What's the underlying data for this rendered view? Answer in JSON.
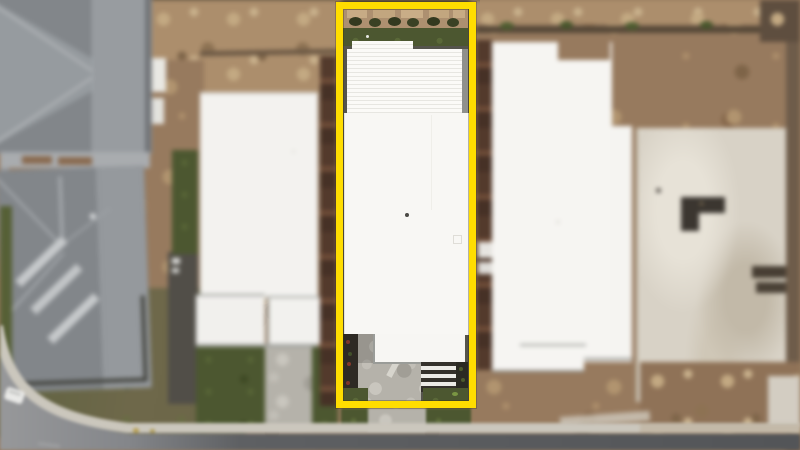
{
  "scene": {
    "kind": "aerial-drone-photo",
    "subject": "residential-lot-highlighted-with-yellow-boundary",
    "highlight": {
      "shape": "rectangle-outline",
      "color_ref": "highlight"
    },
    "regions": [
      "gray-roof-house-top-left",
      "gray-roof-house-left",
      "white-roof-building-left",
      "highlighted-lot-white-roof-house",
      "white-roof-building-right",
      "concrete-slab-construction-site-right",
      "dirt-vacant-ground",
      "front-garden-and-turf",
      "driveway",
      "street-bottom",
      "street-corner-left"
    ]
  },
  "colors": {
    "highlight": "#FFDD00",
    "roof-white": "#F8F7F4",
    "roof-gray": "#82868A",
    "grass": "#4C5730",
    "dirt": "#977A5E",
    "slab": "#D8D2C6",
    "driveway": "#B5B2AA",
    "asphalt": "#595B5E",
    "curb": "#CBC7BD",
    "fence-brown": "#4F382C",
    "structure-dark": "#34312B"
  }
}
